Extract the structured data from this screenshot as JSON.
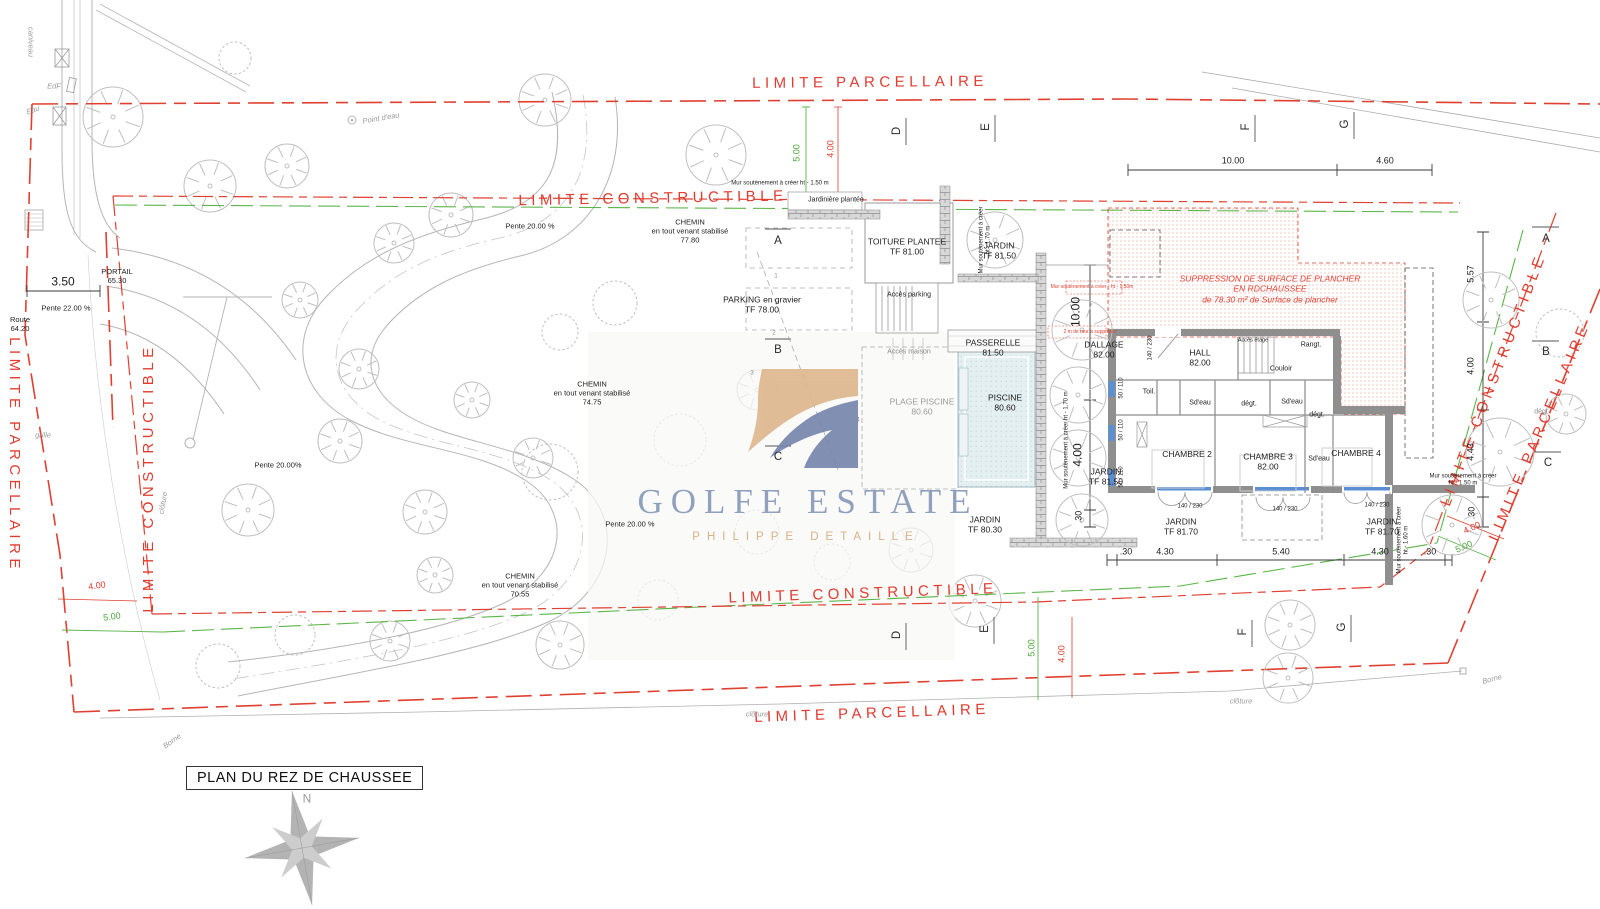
{
  "colors": {
    "boundary_red": "#e03c30",
    "constructible_green": "#5cb54a",
    "ink": "#222222",
    "site_gray": "#b5b5b5",
    "wall_gray": "#8f8f8f",
    "pool_blue": "#e3eff1",
    "logo_tan": "#ddb58c",
    "logo_blue": "#7484ac",
    "watermark_blue": "#7c8fb3",
    "watermark_tan": "#d6a878"
  },
  "title_block": {
    "text": "PLAN DU REZ DE CHAUSSEE"
  },
  "watermark": {
    "title": "GOLFE ESTATE",
    "subtitle": "PHILIPPE DETAILLE"
  },
  "labels": [
    {
      "n": "limite-parcellaire-top-label",
      "t": "LIMITE PARCELLAIRE",
      "x": 870,
      "y": 83,
      "r": -0.5,
      "c": "rt"
    },
    {
      "n": "limite-constructible-top-label",
      "t": "LIMITE CONSTRUCTIBLE",
      "x": 653,
      "y": 199,
      "r": -1,
      "c": "rt"
    },
    {
      "n": "limite-constructible-bottom-label",
      "t": "LIMITE CONSTRUCTIBLE",
      "x": 863,
      "y": 594,
      "r": -2,
      "c": "rt"
    },
    {
      "n": "limite-parcellaire-bottom-label",
      "t": "LIMITE PARCELLAIRE",
      "x": 872,
      "y": 714,
      "r": -2,
      "c": "rt"
    },
    {
      "n": "limite-parcellaire-left-label",
      "t": "LIMITE PARCELLAIRE",
      "x": 14,
      "y": 455,
      "r": 90,
      "c": "rt"
    },
    {
      "n": "limite-constructible-left-label",
      "t": "LIMITE CONSTRUCTIBLE",
      "x": 149,
      "y": 478,
      "r": -90,
      "c": "rt"
    },
    {
      "n": "limite-constructible-right-label",
      "t": "LIMITE CONSTRUCTIBLE",
      "x": 1494,
      "y": 380,
      "r": -69,
      "c": "rt"
    },
    {
      "n": "limite-parcellaire-right-label",
      "t": "LIMITE PARCELLAIRE",
      "x": 1540,
      "y": 432,
      "r": -67,
      "c": "rt"
    },
    {
      "n": "dim-top-1000",
      "t": "10.00",
      "x": 1233,
      "y": 161,
      "c": "dim"
    },
    {
      "n": "dim-top-460",
      "t": "4.60",
      "x": 1385,
      "y": 161,
      "c": "dim"
    },
    {
      "n": "dim-right-557",
      "t": "5.57",
      "x": 1471,
      "y": 274,
      "r": -90,
      "c": "dim"
    },
    {
      "n": "dim-right-400",
      "t": "4.00",
      "x": 1471,
      "y": 366,
      "r": -90,
      "c": "dim"
    },
    {
      "n": "dim-right-443",
      "t": "4.43",
      "x": 1471,
      "y": 452,
      "r": -90,
      "c": "dim"
    },
    {
      "n": "dim-right-30",
      "t": ".30",
      "x": 1472,
      "y": 513,
      "r": -90,
      "c": "dim"
    },
    {
      "n": "dim-bot-30a",
      "t": ".30",
      "x": 1126,
      "y": 552,
      "c": "dim"
    },
    {
      "n": "dim-bot-430a",
      "t": "4.30",
      "x": 1165,
      "y": 552,
      "c": "dim"
    },
    {
      "n": "dim-bot-540",
      "t": "5.40",
      "x": 1281,
      "y": 552,
      "c": "dim"
    },
    {
      "n": "dim-bot-430b",
      "t": "4.30",
      "x": 1380,
      "y": 552,
      "c": "dim"
    },
    {
      "n": "dim-bot-30b",
      "t": ".30",
      "x": 1430,
      "y": 552,
      "c": "dim"
    },
    {
      "n": "dim-350",
      "t": "3.50",
      "x": 63,
      "y": 282,
      "c": "dim12"
    },
    {
      "n": "dim-vert-1000",
      "t": "10.00",
      "x": 1076,
      "y": 312,
      "r": -90,
      "c": "dim12"
    },
    {
      "n": "dim-vert-400",
      "t": "4.00",
      "x": 1078,
      "y": 455,
      "r": -90,
      "c": "dim12"
    },
    {
      "n": "dim-vert-30",
      "t": ".30",
      "x": 1079,
      "y": 517,
      "r": -90,
      "c": "dim"
    },
    {
      "n": "dim-green-500-top",
      "t": "5.00",
      "x": 797,
      "y": 153,
      "r": -90,
      "c": "grn"
    },
    {
      "n": "dim-red-400-top",
      "t": "4.00",
      "x": 831,
      "y": 149,
      "r": -90,
      "c": "red"
    },
    {
      "n": "dim-green-500-botleft",
      "t": "5.00",
      "x": 112,
      "y": 617,
      "r": -8,
      "c": "grn"
    },
    {
      "n": "dim-red-400-botleft",
      "t": "4.00",
      "x": 97,
      "y": 586,
      "r": -8,
      "c": "red"
    },
    {
      "n": "dim-green-500-bottom",
      "t": "5.00",
      "x": 1032,
      "y": 648,
      "r": -90,
      "c": "grn"
    },
    {
      "n": "dim-red-400-bottom",
      "t": "4.00",
      "x": 1062,
      "y": 654,
      "r": -90,
      "c": "red"
    },
    {
      "n": "dim-red-400-botright",
      "t": "4.00",
      "x": 1472,
      "y": 528,
      "r": -24,
      "c": "red"
    },
    {
      "n": "dim-green-500-botright",
      "t": "5.00",
      "x": 1464,
      "y": 547,
      "r": -24,
      "c": "grn"
    },
    {
      "n": "grid-top-d",
      "t": "D",
      "x": 897,
      "y": 131,
      "r": -90,
      "c": "grid"
    },
    {
      "n": "grid-top-e",
      "t": "E",
      "x": 986,
      "y": 127,
      "r": -90,
      "c": "grid"
    },
    {
      "n": "grid-top-f",
      "t": "F",
      "x": 1246,
      "y": 127,
      "r": -90,
      "c": "grid"
    },
    {
      "n": "grid-top-g",
      "t": "G",
      "x": 1345,
      "y": 124,
      "r": -90,
      "c": "grid"
    },
    {
      "n": "grid-bottom-d",
      "t": "D",
      "x": 897,
      "y": 635,
      "r": -90,
      "c": "grid"
    },
    {
      "n": "grid-bottom-e",
      "t": "E",
      "x": 985,
      "y": 629,
      "r": -90,
      "c": "grid"
    },
    {
      "n": "grid-bottom-f",
      "t": "F",
      "x": 1243,
      "y": 632,
      "r": -90,
      "c": "grid"
    },
    {
      "n": "grid-bottom-g",
      "t": "G",
      "x": 1342,
      "y": 627,
      "r": -90,
      "c": "grid"
    },
    {
      "n": "grid-mid-a",
      "t": "A",
      "x": 778,
      "y": 241,
      "c": "grid"
    },
    {
      "n": "grid-mid-b",
      "t": "B",
      "x": 778,
      "y": 350,
      "c": "grid"
    },
    {
      "n": "grid-mid-c",
      "t": "C",
      "x": 778,
      "y": 457,
      "c": "grid"
    },
    {
      "n": "grid-right-a",
      "t": "A",
      "x": 1546,
      "y": 239,
      "c": "grid"
    },
    {
      "n": "grid-right-b",
      "t": "B",
      "x": 1546,
      "y": 352,
      "c": "grid"
    },
    {
      "n": "grid-right-c",
      "t": "C",
      "x": 1548,
      "y": 463,
      "c": "grid"
    },
    {
      "n": "sec-mark-1",
      "t": "1",
      "x": 776,
      "y": 277,
      "c": "tiny6g"
    },
    {
      "n": "sec-mark-2",
      "t": "2",
      "x": 774,
      "y": 334,
      "c": "tiny6g"
    },
    {
      "n": "sec-mark-3",
      "t": "3",
      "x": 752,
      "y": 374,
      "c": "tiny6g"
    },
    {
      "n": "sec-mark-4",
      "t": "4",
      "x": 858,
      "y": 421,
      "c": "tiny6g"
    },
    {
      "n": "portail-label",
      "t": "PORTAIL\n65.30",
      "x": 117,
      "y": 276,
      "c": "note"
    },
    {
      "n": "route-label",
      "t": "Route\n64.20",
      "x": 20,
      "y": 324,
      "c": "note"
    },
    {
      "n": "pente-22-label",
      "t": "Pente 22.00 %",
      "x": 66,
      "y": 308,
      "c": "note"
    },
    {
      "n": "grille-label",
      "t": "grille",
      "x": 43,
      "y": 435,
      "c": "gri"
    },
    {
      "n": "caniveau-label",
      "t": "caniveau",
      "x": 31,
      "y": 42,
      "r": 90,
      "c": "gri"
    },
    {
      "n": "edf-label",
      "t": "EdF",
      "x": 54,
      "y": 86,
      "c": "gri"
    },
    {
      "n": "eau-label",
      "t": "Eau",
      "x": 33,
      "y": 110,
      "r": -20,
      "c": "gri"
    },
    {
      "n": "point-deau-label",
      "t": "Point d'eau",
      "x": 381,
      "y": 118,
      "r": -10,
      "c": "gri"
    },
    {
      "n": "chemin-1-label",
      "t": "CHEMIN\nen tout venant stabilisé\n77.80",
      "x": 690,
      "y": 231,
      "c": "note"
    },
    {
      "n": "chemin-2-label",
      "t": "CHEMIN\nen tout venant stabilisé\n74.75",
      "x": 592,
      "y": 393,
      "c": "note"
    },
    {
      "n": "chemin-3-label",
      "t": "CHEMIN\nen tout venant stabilisé\n70.55",
      "x": 520,
      "y": 585,
      "c": "note"
    },
    {
      "n": "pente-20-a-label",
      "t": "Pente 20.00 %",
      "x": 530,
      "y": 226,
      "c": "note"
    },
    {
      "n": "pente-20-b-label",
      "t": "Pente 20.00%",
      "x": 278,
      "y": 465,
      "c": "note"
    },
    {
      "n": "pente-20-c-label",
      "t": "Pente 20.00 %",
      "x": 630,
      "y": 524,
      "c": "note"
    },
    {
      "n": "jardiniere-label",
      "t": "Jardinière plantée",
      "x": 836,
      "y": 201,
      "c": "tiny7"
    },
    {
      "n": "mur-soutenement-top-label",
      "t": "Mur soutènement à créer ht - 1.50 m",
      "x": 780,
      "y": 184,
      "c": "tiny6"
    },
    {
      "n": "mur-soutenement-v1-label",
      "t": "Mur soutènement à créer\nht - 1.70 m",
      "x": 986,
      "y": 240,
      "r": -90,
      "c": "tiny6"
    },
    {
      "n": "mur-soutenement-v2-label",
      "t": "Mur soutènement à créer ht - 1.70 m",
      "x": 1067,
      "y": 440,
      "r": -90,
      "c": "tiny6"
    },
    {
      "n": "mur-soutenement-right-label",
      "t": "Mur soutènement à créer\nht - 1.50 m",
      "x": 1463,
      "y": 481,
      "c": "tiny6"
    },
    {
      "n": "mur-soutenement-v3-label",
      "t": "Mur soutènement à créer\nht - 1.60 m",
      "x": 1404,
      "y": 540,
      "r": -90,
      "c": "tiny6"
    },
    {
      "n": "toiture-plantee-label",
      "t": "TOITURE PLANTEE\nTF 81.00",
      "x": 907,
      "y": 247,
      "c": "room"
    },
    {
      "n": "jardin-top-label",
      "t": "JARDIN\nTF 81.50",
      "x": 999,
      "y": 251,
      "c": "room"
    },
    {
      "n": "parking-label",
      "t": "PARKING en gravier\nTF 78.00",
      "x": 762,
      "y": 305,
      "c": "room"
    },
    {
      "n": "acces-parking-label",
      "t": "Accès parking",
      "x": 909,
      "y": 296,
      "c": "tiny7"
    },
    {
      "n": "acces-maison-label",
      "t": "Accès maison",
      "x": 909,
      "y": 353,
      "c": "tiny7g"
    },
    {
      "n": "passerelle-label",
      "t": "PASSERELLE\n81.50",
      "x": 993,
      "y": 348,
      "c": "room"
    },
    {
      "n": "dallage-label",
      "t": "DALLAGE\n82.00",
      "x": 1104,
      "y": 350,
      "c": "room"
    },
    {
      "n": "hall-label",
      "t": "HALL\n82.00",
      "x": 1200,
      "y": 358,
      "c": "room"
    },
    {
      "n": "couloir-label",
      "t": "Couloir",
      "x": 1281,
      "y": 370,
      "c": "tiny7"
    },
    {
      "n": "rangt-label",
      "t": "Rangt.",
      "x": 1311,
      "y": 346,
      "c": "tiny7"
    },
    {
      "n": "acces-etage-label",
      "t": "Accès étage",
      "x": 1253,
      "y": 341,
      "c": "tiny55"
    },
    {
      "n": "toil-label",
      "t": "Toil.",
      "x": 1149,
      "y": 393,
      "c": "tiny7"
    },
    {
      "n": "sdeau-1-label",
      "t": "Sd'eau",
      "x": 1200,
      "y": 404,
      "c": "tiny7"
    },
    {
      "n": "degt-1-label",
      "t": "dégt.",
      "x": 1249,
      "y": 405,
      "c": "tiny7"
    },
    {
      "n": "sdeau-2-label",
      "t": "Sd'eau",
      "x": 1292,
      "y": 403,
      "c": "tiny7"
    },
    {
      "n": "degt-2-label",
      "t": "dégt.",
      "x": 1317,
      "y": 416,
      "c": "tiny7"
    },
    {
      "n": "sdeau-3-label",
      "t": "Sd'eau",
      "x": 1319,
      "y": 460,
      "c": "tiny7"
    },
    {
      "n": "degt-right-label",
      "t": "dégt.",
      "x": 1542,
      "y": 413,
      "c": "tiny7g"
    },
    {
      "n": "chambre-2-label",
      "t": "CHAMBRE 2",
      "x": 1187,
      "y": 454,
      "c": "room"
    },
    {
      "n": "chambre-3-label",
      "t": "CHAMBRE 3\n82.00",
      "x": 1268,
      "y": 462,
      "c": "room"
    },
    {
      "n": "chambre-4-label",
      "t": "CHAMBRE 4",
      "x": 1356,
      "y": 453,
      "c": "room"
    },
    {
      "n": "jardin-strip-label",
      "t": "JARDIN\nTF 81.50",
      "x": 1106,
      "y": 477,
      "c": "room"
    },
    {
      "n": "jardin-mid-label",
      "t": "JARDIN\nTF 80.30",
      "x": 985,
      "y": 525,
      "c": "room"
    },
    {
      "n": "jardin-b1-label",
      "t": "JARDIN\nTF 81.70",
      "x": 1181,
      "y": 527,
      "c": "room"
    },
    {
      "n": "jardin-b2-label",
      "t": "JARDIN\nTF 81.70",
      "x": 1382,
      "y": 527,
      "c": "room"
    },
    {
      "n": "plage-piscine-label",
      "t": "PLAGE PISCINE\n80.60",
      "x": 922,
      "y": 407,
      "c": "roomfade"
    },
    {
      "n": "piscine-label",
      "t": "PISCINE\n80.60",
      "x": 1005,
      "y": 403,
      "c": "room"
    },
    {
      "n": "window-140-230-west",
      "t": "140 / 230",
      "x": 1151,
      "y": 348,
      "r": -90,
      "c": "tiny6"
    },
    {
      "n": "window-50-110-a",
      "t": "50 / 110",
      "x": 1122,
      "y": 388,
      "r": -90,
      "c": "tiny6"
    },
    {
      "n": "window-50-110-b",
      "t": "50 / 110",
      "x": 1122,
      "y": 430,
      "r": -90,
      "c": "tiny6"
    },
    {
      "n": "window-50-110-c",
      "t": "50 / 110",
      "x": 1122,
      "y": 477,
      "r": -90,
      "c": "tiny6"
    },
    {
      "n": "window-140-230-s1",
      "t": "140 / 230",
      "x": 1190,
      "y": 507,
      "c": "tiny6"
    },
    {
      "n": "window-140-230-s2",
      "t": "140 / 230",
      "x": 1285,
      "y": 510,
      "c": "tiny6"
    },
    {
      "n": "window-140-230-s3",
      "t": "140 / 230",
      "x": 1377,
      "y": 506,
      "c": "tiny6"
    },
    {
      "n": "suppression-note",
      "t": "SUPPRESSION DE SURFACE DE PLANCHER\nEN RDCHAUSSEE\nde 78.30 m² de Surface de plancher",
      "x": 1270,
      "y": 289,
      "c": "redit"
    },
    {
      "n": "mur-red-note-1",
      "t": "Mur soutènement à créer - ht - 1.50m",
      "x": 1092,
      "y": 287,
      "c": "redtiny"
    },
    {
      "n": "mur-red-note-2",
      "t": "2 m de mur à supprimer",
      "x": 1090,
      "y": 332,
      "c": "redtiny"
    },
    {
      "n": "cloture-bottomleft-label",
      "t": "clôture",
      "x": 757,
      "y": 714,
      "c": "gri"
    },
    {
      "n": "cloture-bottomright-label",
      "t": "clôture",
      "x": 1241,
      "y": 701,
      "c": "gri"
    },
    {
      "n": "cloture-left-label",
      "t": "clôture",
      "x": 163,
      "y": 503,
      "r": -80,
      "c": "gri"
    },
    {
      "n": "borne-bottomright-label",
      "t": "Borne",
      "x": 1492,
      "y": 679,
      "r": -15,
      "c": "gri"
    },
    {
      "n": "borne-bottomleft-label",
      "t": "Borne",
      "x": 172,
      "y": 741,
      "r": -35,
      "c": "gri"
    },
    {
      "n": "compass-north-label",
      "t": "N",
      "x": 307,
      "y": 799,
      "c": "compassN"
    }
  ],
  "site": {
    "trees": [
      [
        113,
        117,
        30,
        "t"
      ],
      [
        235,
        58,
        16,
        "s"
      ],
      [
        210,
        186,
        26,
        "t"
      ],
      [
        287,
        166,
        22,
        "t"
      ],
      [
        451,
        215,
        22,
        "t"
      ],
      [
        545,
        100,
        26,
        "t"
      ],
      [
        716,
        155,
        30,
        "t"
      ],
      [
        394,
        243,
        20,
        "t"
      ],
      [
        300,
        300,
        18,
        "t"
      ],
      [
        359,
        369,
        20,
        "t"
      ],
      [
        340,
        441,
        22,
        "t"
      ],
      [
        472,
        400,
        18,
        "t"
      ],
      [
        533,
        458,
        20,
        "t"
      ],
      [
        425,
        512,
        22,
        "t"
      ],
      [
        248,
        510,
        26,
        "t"
      ],
      [
        615,
        303,
        22,
        "s"
      ],
      [
        560,
        332,
        18,
        "s"
      ],
      [
        680,
        440,
        26,
        "s"
      ],
      [
        757,
        390,
        20,
        "t"
      ],
      [
        550,
        472,
        28,
        "s"
      ],
      [
        435,
        575,
        18,
        "t"
      ],
      [
        560,
        645,
        24,
        "t"
      ],
      [
        658,
        600,
        20,
        "s"
      ],
      [
        295,
        635,
        20,
        "s"
      ],
      [
        390,
        641,
        20,
        "t"
      ],
      [
        218,
        666,
        22,
        "s"
      ],
      [
        911,
        550,
        22,
        "t"
      ],
      [
        975,
        601,
        26,
        "t"
      ],
      [
        832,
        562,
        18,
        "s"
      ],
      [
        757,
        532,
        22,
        "s"
      ],
      [
        1290,
        625,
        25,
        "t"
      ],
      [
        1288,
        678,
        25,
        "t"
      ],
      [
        995,
        240,
        28,
        "t"
      ],
      [
        1082,
        330,
        30,
        "t"
      ],
      [
        1078,
        395,
        28,
        "t"
      ],
      [
        1078,
        458,
        28,
        "t"
      ],
      [
        1082,
        520,
        26,
        "t"
      ],
      [
        1491,
        300,
        28,
        "t"
      ],
      [
        1500,
        452,
        34,
        "t"
      ],
      [
        1560,
        333,
        24,
        "s"
      ],
      [
        1452,
        525,
        30,
        "t"
      ],
      [
        1566,
        414,
        20,
        "t"
      ]
    ]
  }
}
